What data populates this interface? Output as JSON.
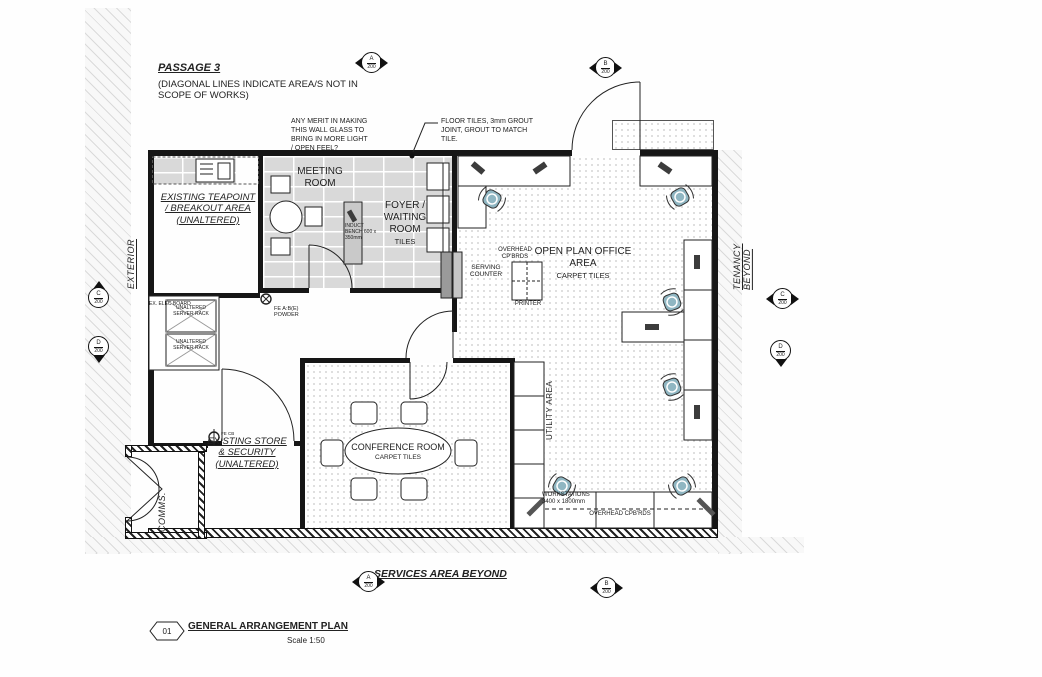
{
  "passage": {
    "title": "PASSAGE 3",
    "note": "(DIAGONAL LINES INDICATE AREA/S NOT IN SCOPE OF WORKS)"
  },
  "annotations": {
    "wall_glass": "ANY MERIT IN MAKING THIS WALL GLASS TO BRING IN MORE LIGHT / OPEN FEEL?",
    "floor_tiles": "FLOOR TILES, 3mm GROUT JOINT, GROUT TO MATCH TILE."
  },
  "rooms": {
    "meeting": {
      "name": "MEETING ROOM"
    },
    "foyer": {
      "name": "FOYER / WAITING ROOM",
      "floor": "TILES"
    },
    "teapoint": {
      "name": "EXISTING TEAPOINT / BREAKOUT AREA (UNALTERED)"
    },
    "open_plan": {
      "name": "OPEN PLAN OFFICE AREA",
      "floor": "CARPET TILES"
    },
    "conference": {
      "name": "CONFERENCE ROOM",
      "floor": "CARPET TILES"
    },
    "store": {
      "name": "EXISTING STORE & SECURITY (UNALTERED)"
    },
    "comms": {
      "name": "COMMS."
    },
    "utility": {
      "name": "UTILITY AREA"
    },
    "exterior": {
      "name": "EXTERIOR"
    },
    "tenancy": {
      "name": "TENANCY BEYOND"
    },
    "services": {
      "name": "SERVICES AREA BEYOND"
    }
  },
  "fixtures": {
    "induct_bench": "INDUCT BENCH 600 x 350mm",
    "overhead_cpbrds": "OVERHEAD CP'BRDS",
    "serving_counter": "SERVING COUNTER",
    "printer": "PRINTER",
    "elec_board": "EX. ELEC BOARD",
    "server_rack_1": "UNALTERED SERVER RACK",
    "server_rack_2": "UNALTERED SERVER RACK",
    "fire_extinguisher": "FE A:B(E) POWDER",
    "fire_extinguisher_2": "FE CB",
    "workstations": "WORKSTATIONS 3400 x 1800mm",
    "overhead_cupboards": "OVERHEAD CPB'RDS"
  },
  "markers": {
    "top_a": {
      "letter": "A",
      "number": "200"
    },
    "top_b": {
      "letter": "B",
      "number": "200"
    },
    "left_c": {
      "letter": "C",
      "number": "200"
    },
    "left_d": {
      "letter": "D",
      "number": "200"
    },
    "right_c": {
      "letter": "C",
      "number": "200"
    },
    "right_d": {
      "letter": "D",
      "number": "200"
    },
    "bottom_a": {
      "letter": "A",
      "number": "200"
    },
    "bottom_b": {
      "letter": "B",
      "number": "200"
    }
  },
  "title_block": {
    "number": "01",
    "title": "GENERAL ARRANGEMENT PLAN",
    "scale": "Scale 1:50"
  },
  "colors": {
    "chair_upholstery": "#8FB6C2",
    "tile_floor": "#D9D9D9",
    "line": "#1A1A1A"
  }
}
